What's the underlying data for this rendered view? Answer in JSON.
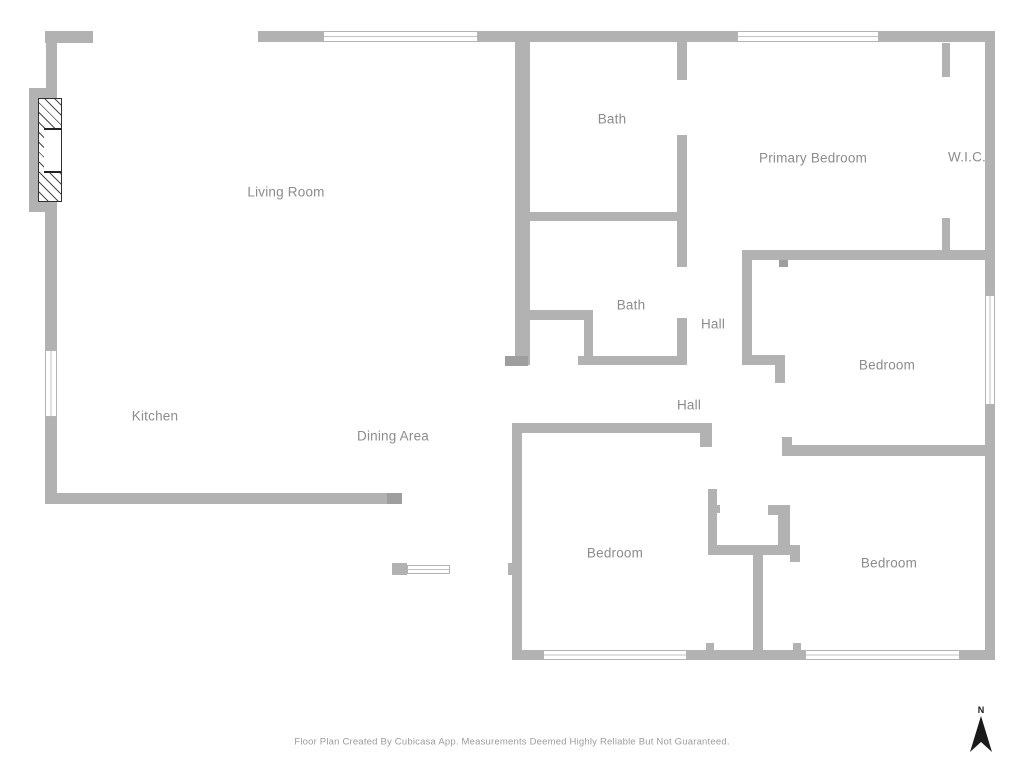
{
  "plan": {
    "footer": "Floor Plan Created By Cubicasa App. Measurements Deemed Highly Reliable But Not Guaranteed.",
    "north_label": "N",
    "colors": {
      "wall": "#b2b2b2",
      "wall_dark": "#9e9e9e",
      "label": "#8c8c8c",
      "footer": "#9c9c9c",
      "north": "#1a1a1a"
    },
    "rooms": [
      {
        "name": "living-room",
        "label": "Living Room",
        "cx": 286,
        "cy": 192
      },
      {
        "name": "bath-upper",
        "label": "Bath",
        "cx": 612,
        "cy": 119
      },
      {
        "name": "primary-bedroom",
        "label": "Primary Bedroom",
        "cx": 813,
        "cy": 158
      },
      {
        "name": "wic",
        "label": "W.I.C.",
        "cx": 967,
        "cy": 157
      },
      {
        "name": "bath-lower",
        "label": "Bath",
        "cx": 631,
        "cy": 305
      },
      {
        "name": "hall-upper",
        "label": "Hall",
        "cx": 713,
        "cy": 324
      },
      {
        "name": "bedroom-right-middle",
        "label": "Bedroom",
        "cx": 887,
        "cy": 365
      },
      {
        "name": "hall-lower",
        "label": "Hall",
        "cx": 689,
        "cy": 405
      },
      {
        "name": "kitchen",
        "label": "Kitchen",
        "cx": 155,
        "cy": 416
      },
      {
        "name": "dining-area",
        "label": "Dining Area",
        "cx": 393,
        "cy": 436
      },
      {
        "name": "bedroom-bottom-left",
        "label": "Bedroom",
        "cx": 615,
        "cy": 553
      },
      {
        "name": "bedroom-bottom-right",
        "label": "Bedroom",
        "cx": 889,
        "cy": 563
      }
    ],
    "walls": [
      {
        "x": 45,
        "y": 31,
        "w": 48,
        "h": 12
      },
      {
        "x": 46,
        "y": 43,
        "w": 11,
        "h": 46
      },
      {
        "x": 29,
        "y": 88,
        "w": 28,
        "h": 124
      },
      {
        "x": 45,
        "y": 210,
        "w": 12,
        "h": 141
      },
      {
        "x": 45,
        "y": 416,
        "w": 12,
        "h": 88
      },
      {
        "x": 45,
        "y": 493,
        "w": 357,
        "h": 11
      },
      {
        "x": 387,
        "y": 493,
        "w": 15,
        "h": 11,
        "dark": true
      },
      {
        "x": 258,
        "y": 31,
        "w": 65,
        "h": 11
      },
      {
        "x": 478,
        "y": 31,
        "w": 259,
        "h": 11
      },
      {
        "x": 879,
        "y": 31,
        "w": 116,
        "h": 11
      },
      {
        "x": 985,
        "y": 42,
        "w": 10,
        "h": 253
      },
      {
        "x": 985,
        "y": 405,
        "w": 10,
        "h": 255
      },
      {
        "x": 512,
        "y": 650,
        "w": 31,
        "h": 10
      },
      {
        "x": 687,
        "y": 650,
        "w": 118,
        "h": 10
      },
      {
        "x": 960,
        "y": 650,
        "w": 35,
        "h": 10
      },
      {
        "x": 515,
        "y": 42,
        "w": 15,
        "h": 323
      },
      {
        "x": 677,
        "y": 42,
        "w": 10,
        "h": 38
      },
      {
        "x": 677,
        "y": 135,
        "w": 10,
        "h": 132
      },
      {
        "x": 677,
        "y": 318,
        "w": 10,
        "h": 47
      },
      {
        "x": 530,
        "y": 212,
        "w": 147,
        "h": 9
      },
      {
        "x": 528,
        "y": 310,
        "w": 65,
        "h": 10
      },
      {
        "x": 584,
        "y": 320,
        "w": 9,
        "h": 45
      },
      {
        "x": 578,
        "y": 356,
        "w": 109,
        "h": 9
      },
      {
        "x": 505,
        "y": 356,
        "w": 23,
        "h": 10,
        "dark": true
      },
      {
        "x": 942,
        "y": 43,
        "w": 8,
        "h": 34
      },
      {
        "x": 942,
        "y": 218,
        "w": 8,
        "h": 32
      },
      {
        "x": 742,
        "y": 250,
        "w": 253,
        "h": 10
      },
      {
        "x": 779,
        "y": 260,
        "w": 9,
        "h": 7,
        "dark": true
      },
      {
        "x": 742,
        "y": 250,
        "w": 10,
        "h": 115
      },
      {
        "x": 742,
        "y": 355,
        "w": 43,
        "h": 10
      },
      {
        "x": 775,
        "y": 365,
        "w": 10,
        "h": 18
      },
      {
        "x": 782,
        "y": 445,
        "w": 204,
        "h": 11
      },
      {
        "x": 782,
        "y": 437,
        "w": 10,
        "h": 19
      },
      {
        "x": 512,
        "y": 423,
        "w": 200,
        "h": 10
      },
      {
        "x": 700,
        "y": 423,
        "w": 12,
        "h": 24
      },
      {
        "x": 512,
        "y": 423,
        "w": 10,
        "h": 227
      },
      {
        "x": 508,
        "y": 563,
        "w": 4,
        "h": 12
      },
      {
        "x": 708,
        "y": 489,
        "w": 9,
        "h": 57
      },
      {
        "x": 716,
        "y": 505,
        "w": 4,
        "h": 8
      },
      {
        "x": 708,
        "y": 545,
        "w": 82,
        "h": 10
      },
      {
        "x": 790,
        "y": 545,
        "w": 10,
        "h": 17
      },
      {
        "x": 768,
        "y": 505,
        "w": 22,
        "h": 10
      },
      {
        "x": 778,
        "y": 505,
        "w": 12,
        "h": 40
      },
      {
        "x": 753,
        "y": 555,
        "w": 10,
        "h": 97
      },
      {
        "x": 706,
        "y": 643,
        "w": 8,
        "h": 8
      },
      {
        "x": 793,
        "y": 643,
        "w": 8,
        "h": 8
      },
      {
        "x": 392,
        "y": 563,
        "w": 15,
        "h": 12
      }
    ],
    "windows": [
      {
        "x": 323,
        "y": 31,
        "w": 155,
        "h": 11,
        "orient": "h"
      },
      {
        "x": 737,
        "y": 31,
        "w": 142,
        "h": 11,
        "orient": "h"
      },
      {
        "x": 985,
        "y": 295,
        "w": 10,
        "h": 110,
        "orient": "v"
      },
      {
        "x": 45,
        "y": 350,
        "w": 12,
        "h": 67,
        "orient": "v"
      },
      {
        "x": 543,
        "y": 650,
        "w": 144,
        "h": 10,
        "orient": "h"
      },
      {
        "x": 805,
        "y": 650,
        "w": 155,
        "h": 10,
        "orient": "h"
      },
      {
        "x": 407,
        "y": 565,
        "w": 43,
        "h": 9,
        "orient": "h"
      }
    ],
    "fireplace": {
      "hatch": {
        "x": 38,
        "y": 98,
        "w": 24,
        "h": 104
      },
      "opening": {
        "x": 44,
        "y": 128,
        "w": 17,
        "h": 45
      }
    },
    "north": {
      "x": 968,
      "y": 705
    }
  }
}
